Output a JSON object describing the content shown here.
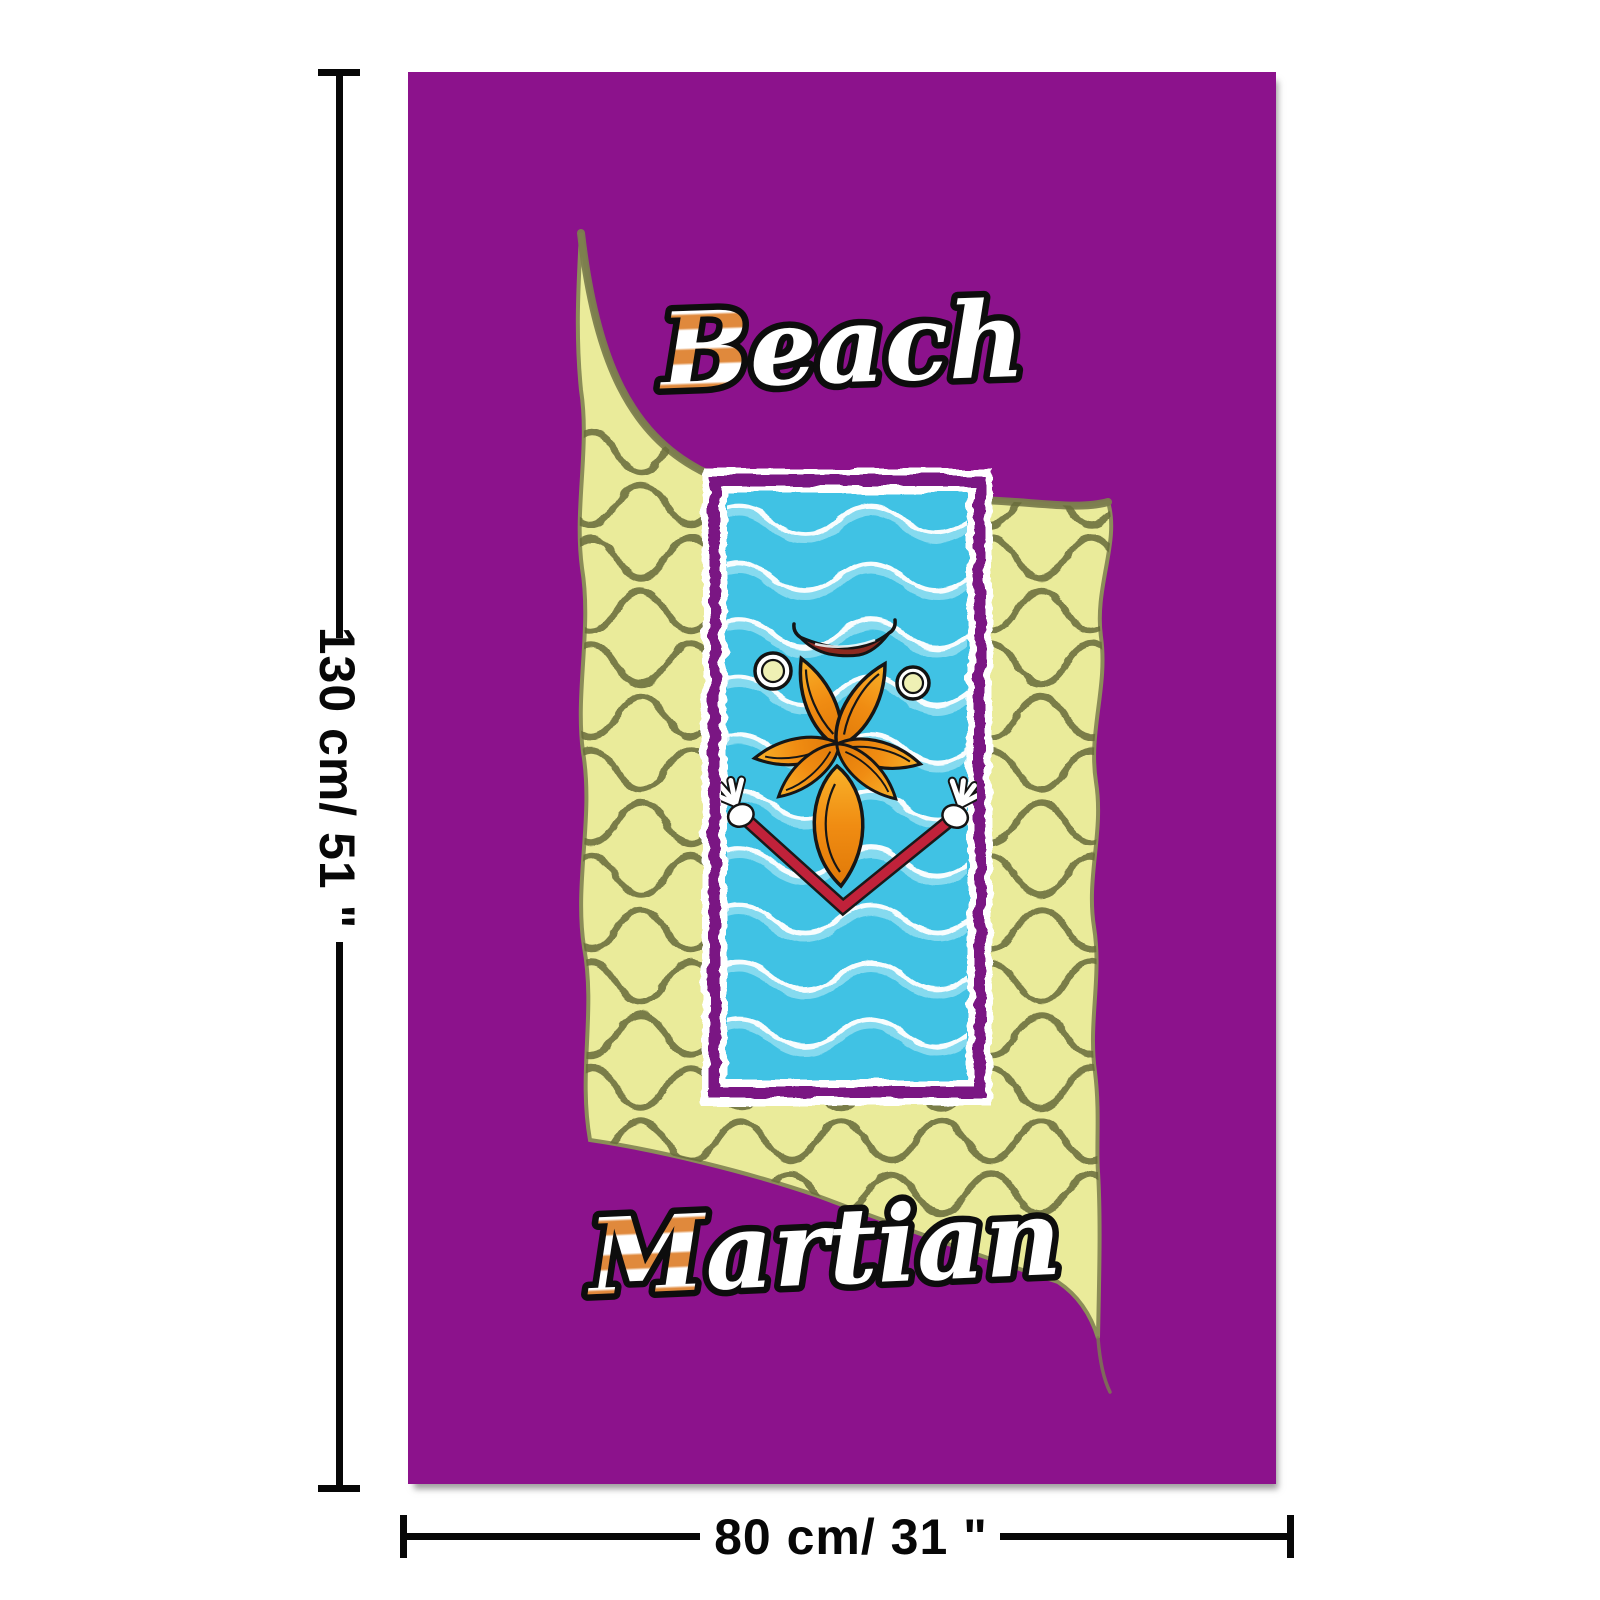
{
  "dimensions": {
    "height_label": "130 cm/ 51 \"",
    "width_label": "80 cm/ 31 \""
  },
  "towel": {
    "labels": {
      "top_initial": "B",
      "top_rest": "each",
      "bottom_initial": "M",
      "bottom_rest": "artian"
    },
    "colors": {
      "towel_purple": "#8c128c",
      "frame_purple": "#7a1283",
      "panel_yellow": "#eaeb9a",
      "wave_olive": "#6b6e3e",
      "swoosh_olive": "#7c7e4e",
      "water_blue": "#3fc2e4",
      "foam_white": "#ffffff",
      "petal_dark": "#e07908",
      "petal_mid": "#f08c12",
      "petal_light": "#f9b32a",
      "stripe_orange": "#e0893c",
      "arm_red": "#c0223a",
      "lip_red": "#8c2a20",
      "eye_cream": "#eff0b4",
      "label_fill": "#ffffff",
      "label_outline": "#0d0d0d",
      "dimension_black": "#070707"
    }
  }
}
